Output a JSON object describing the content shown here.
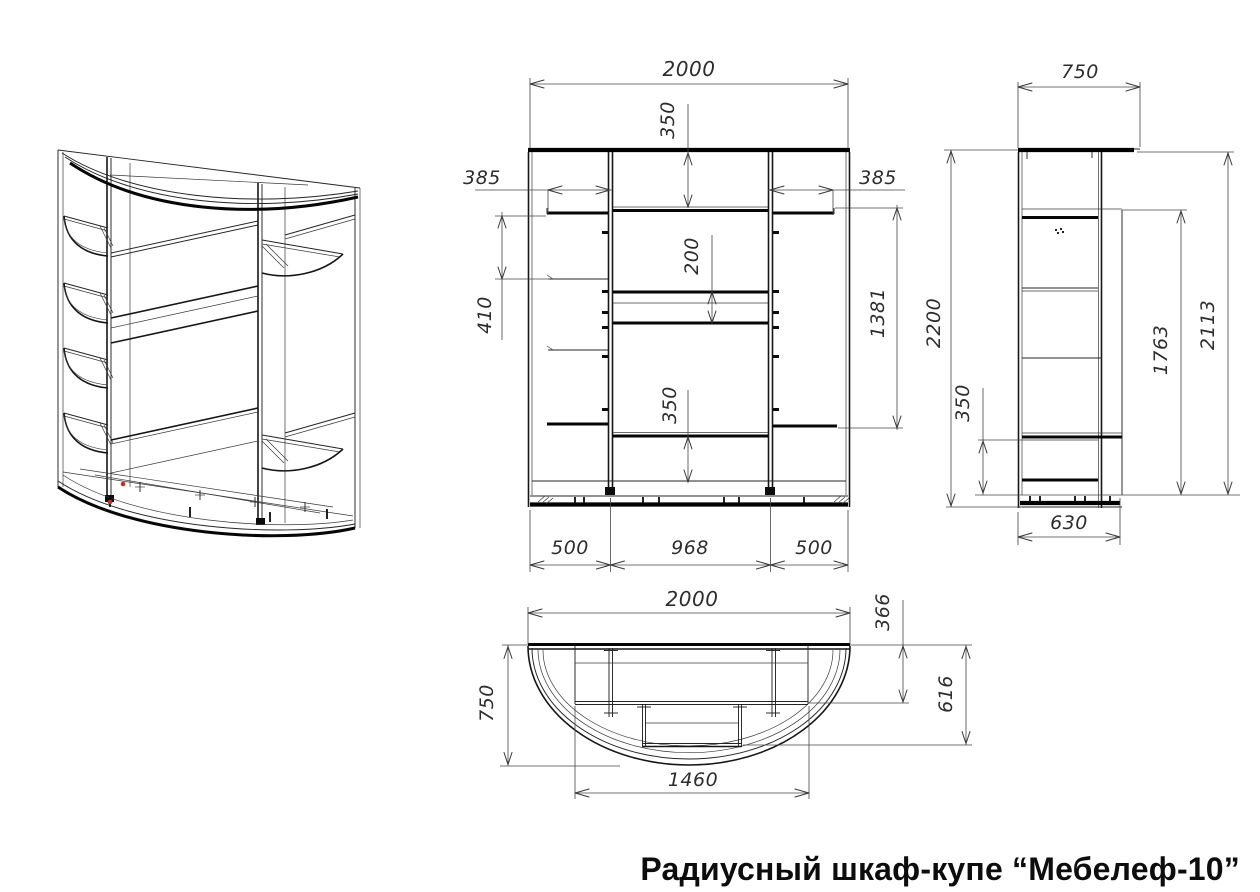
{
  "title": "Радиусный шкаф-купе “Мебелеф-10”",
  "front_view": {
    "overall_width": "2000",
    "top_shelf_drop": "350",
    "left_shelf_width": "385",
    "right_shelf_width": "385",
    "left_shelf_spacing": "410",
    "drawer_opening": "200",
    "hanging_space": "1381",
    "lower_shelf_gap": "350",
    "left_bay_width": "500",
    "center_bay_width": "968",
    "right_bay_width": "500"
  },
  "side_view": {
    "top_depth": "750",
    "overall_height": "2200",
    "interior_height": "1763",
    "carcass_height": "2113",
    "bottom_shelf_gap": "350",
    "carcass_depth": "630"
  },
  "plan_view": {
    "overall_width": "2000",
    "side_section_depth": "366",
    "overall_depth": "750",
    "center_section_depth": "616",
    "front_opening_width": "1460"
  },
  "colors": {
    "line": "#1a1a1a",
    "dimension": "#3a3a3a",
    "marker_red": "#c03028",
    "background": "#ffffff"
  }
}
